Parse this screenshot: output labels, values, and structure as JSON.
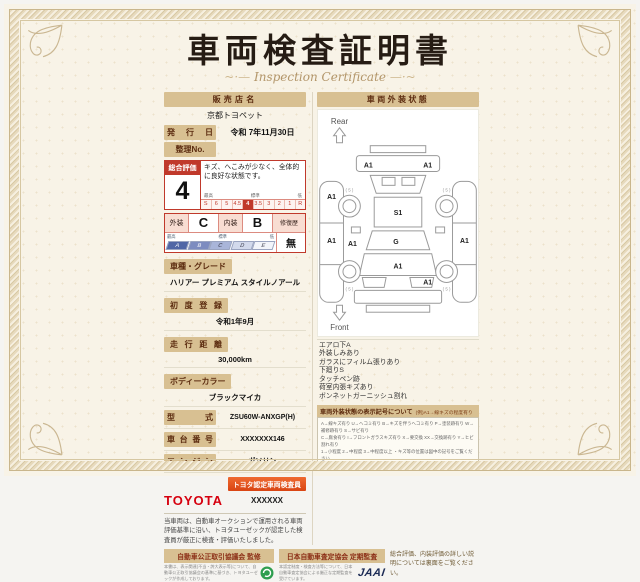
{
  "title": "車両検査証明書",
  "subtitle": "Inspection Certificate",
  "colors": {
    "accent_bar": "#d8c092",
    "rating_red": "#c0392b",
    "toyota_red": "#d6000f",
    "jaai_navy": "#1c2b55",
    "emblem_green": "#2e9e4f"
  },
  "dealer": {
    "label": "販売店名",
    "value": "京都トヨペット"
  },
  "issue_date": {
    "label": "発行日",
    "value": "令和 7年11月30日"
  },
  "ref_no": {
    "label": "整理No.",
    "value": ""
  },
  "overall_rating": {
    "label": "総合評価",
    "score": "4",
    "comment": "キズ、へこみが少なく、全体的に良好な状態です。",
    "scale_high": "最高",
    "scale_mid": "標準",
    "scale_low": "低",
    "scale": [
      "S",
      "6",
      "5",
      "4.5",
      "4",
      "3.5",
      "3",
      "2",
      "1",
      "R"
    ],
    "selected": "4"
  },
  "grades": {
    "exterior_label": "外装",
    "exterior_value": "C",
    "interior_label": "内装",
    "interior_value": "B",
    "repair_label": "修復歴",
    "repair_value": "無",
    "scale_chips": [
      "A",
      "B",
      "C",
      "D",
      "E"
    ],
    "chip_high": "最高",
    "chip_mid": "標準",
    "chip_low": "低"
  },
  "fields": [
    {
      "label": "車種・グレード",
      "value": "ハリアー プレミアム スタイルノアール",
      "layout": "stack"
    },
    {
      "label": "初度登録",
      "value": "令和1年9月",
      "layout": "stack"
    },
    {
      "label": "走行距離",
      "value": "30,000km",
      "layout": "stack"
    },
    {
      "label": "ボディーカラー",
      "value": "ブラックマイカ",
      "layout": "stack"
    },
    {
      "label": "型式",
      "value": "ZSU60W-ANXGP(H)",
      "layout": "inline"
    },
    {
      "label": "車台番号",
      "value": "XXXXXXX146",
      "layout": "inline"
    },
    {
      "label": "エンジン",
      "value": "ガソリン",
      "layout": "inline"
    }
  ],
  "inspector": {
    "brand": "TOYOTA",
    "badge": "トヨタ認定車両検査員",
    "number": "XXXXXX"
  },
  "disclaimer": "当車両は、自動車オークションで運用される車両評価基準に沿い、トヨタユーゼックが認定した検査員が厳正に検査・評価いたしました。",
  "exterior_panel": {
    "header": "車両外装状態",
    "rear_label": "Rear",
    "front_label": "Front",
    "marks": [
      {
        "x": 50,
        "y": 58,
        "t": "A1"
      },
      {
        "x": 110,
        "y": 58,
        "t": "A1"
      },
      {
        "x": 13,
        "y": 90,
        "t": "A1"
      },
      {
        "x": 13,
        "y": 134,
        "t": "A1"
      },
      {
        "x": 34,
        "y": 137,
        "t": "A1"
      },
      {
        "x": 147,
        "y": 134,
        "t": "A1"
      },
      {
        "x": 80,
        "y": 106,
        "t": "S1"
      },
      {
        "x": 78,
        "y": 135,
        "t": "G"
      },
      {
        "x": 80,
        "y": 160,
        "t": "A1"
      },
      {
        "x": 110,
        "y": 176,
        "t": "A1"
      },
      {
        "x": 31,
        "y": 82,
        "t": "( 5 )",
        "s": 1
      },
      {
        "x": 129,
        "y": 82,
        "t": "( 5 )",
        "s": 1
      },
      {
        "x": 31,
        "y": 182,
        "t": "( 5 )",
        "s": 1
      },
      {
        "x": 129,
        "y": 182,
        "t": "( 5 )",
        "s": 1
      }
    ],
    "notes": [
      "エアロ下A",
      "外装しみあり",
      "ガラスにフィルム張りあり",
      "下廻りS",
      "タッチペン跡",
      "荷室内張キズあり",
      "ボンネットガーニッシュ割れ"
    ],
    "legend_title": "車両外装状態の表示記号について",
    "legend_example": "(例)A1→線キズの程度有り",
    "legend_lines": [
      "A→線キズ有り U→ヘコミ有り B→キズを伴うヘコミ有り P→塗装跡有り W→補修跡有り S→サビ有り",
      "C→腐食有り I→フロントガラスキズ有り X→要交換 XX→交換跡有り Y→ヒビ割れ有り",
      "1→小程度 2→中程度 3→中程度以上 ・キズ等の位置は図中の記号をご覧ください"
    ]
  },
  "footer": {
    "left": {
      "title": "自動車公正取引協議会 監修",
      "text": "本書は、表示関連(不当・誇大表示等)について、自動車公正取引協議会の基準に基づき、トヨタユーゼックが作成しております。"
    },
    "right": {
      "title": "日本自動車査定協会 定期監査",
      "text": "本認定制度・検査方法等について、日本自動車査定協会による厳正な定期監査を受けています。",
      "logo": "JAAI"
    },
    "note": "総合評価、内装評価の詳しい説明については裏面をご覧ください。"
  }
}
